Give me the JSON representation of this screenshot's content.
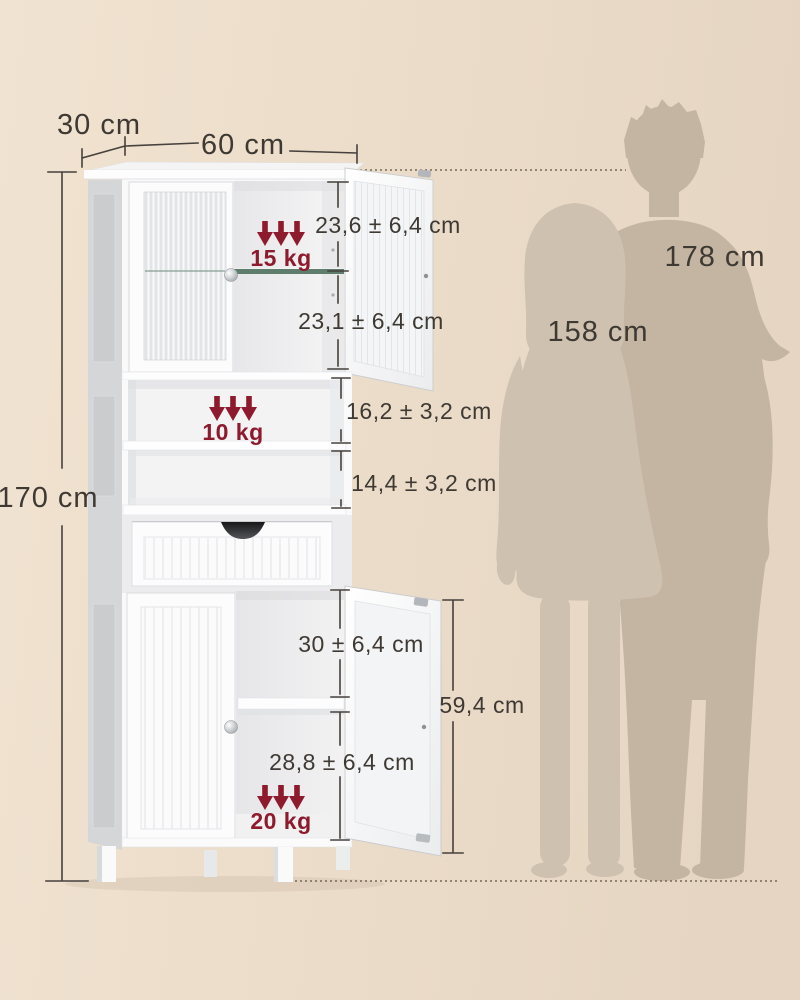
{
  "product_diagram": {
    "overall": {
      "depth": "30 cm",
      "width": "60 cm",
      "height": "170 cm"
    },
    "upper_glass_cabinet": {
      "top_gap": "23,6 ± 6,4 cm",
      "bottom_gap": "23,1 ± 6,4 cm",
      "glass_shelf_capacity": "15 kg"
    },
    "open_compartment": {
      "top_gap": "16,2 ± 3,2 cm",
      "bottom_gap": "14,4 ± 3,2 cm",
      "shelf_capacity": "10 kg"
    },
    "lower_cabinet": {
      "top_gap": "30 ± 6,4 cm",
      "bottom_gap": "28,8 ± 6,4 cm",
      "door_height": "59,4 cm",
      "shelf_capacity": "20 kg"
    },
    "reference_figures": {
      "man_height": "178 cm",
      "woman_height": "158 cm"
    },
    "colors": {
      "accent_red": "#8e1a2d",
      "background_left": "#f1e3d1",
      "background_right": "#e5d5c2",
      "silhouette_man": "#c4b4a2",
      "silhouette_woman": "#cfc1b0",
      "dimension_ink": "#3e3933",
      "cabinet_white": "#fcfcfd",
      "glass_shelf_green": "#5f7d6d"
    }
  }
}
